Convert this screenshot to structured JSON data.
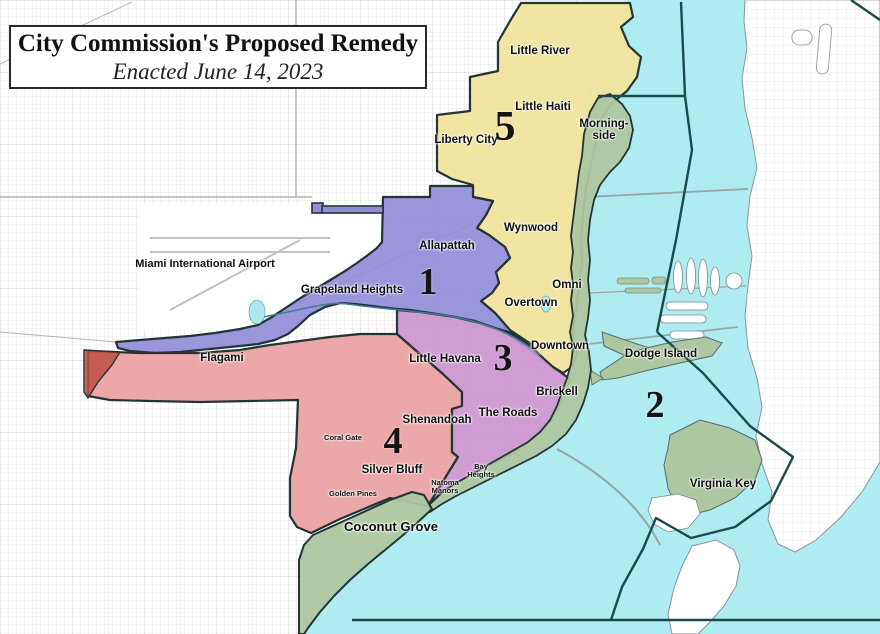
{
  "title": {
    "line1": "City Commission's Proposed Remedy",
    "line2": "Enacted June 14, 2023"
  },
  "airport": {
    "label": "Miami International Airport"
  },
  "districts": [
    {
      "number": "1",
      "color": "#938cd9",
      "neighborhoods": [
        "Allapattah",
        "Grapeland Heights"
      ]
    },
    {
      "number": "2",
      "color": "#adc7a0",
      "water_color": "#afecf2",
      "neighborhoods": [
        "Morning-side",
        "Omni",
        "Dodge Island",
        "Virginia Key",
        "Coconut Grove"
      ]
    },
    {
      "number": "3",
      "color": "#cb94cf",
      "neighborhoods": [
        "Little Havana",
        "The Roads",
        "Brickell",
        "Bay Heights",
        "Natoma Manors"
      ]
    },
    {
      "number": "4",
      "color": "#eaa0a2",
      "neighborhoods": [
        "Flagami",
        "Coral Gate",
        "Shenandoah",
        "Silver Bluff",
        "Golden Pines"
      ]
    },
    {
      "number": "5",
      "color": "#f1e39a",
      "neighborhoods": [
        "Little River",
        "Little Haiti",
        "Liberty City",
        "Wynwood",
        "Overtown",
        "Downtown"
      ]
    }
  ],
  "map_colors": {
    "water": "#afecf2",
    "mainland": "#ffffff",
    "street_grid": "#cccccc",
    "district_boundary": "#223434",
    "offshore_boundary": "#1b4a4a"
  }
}
